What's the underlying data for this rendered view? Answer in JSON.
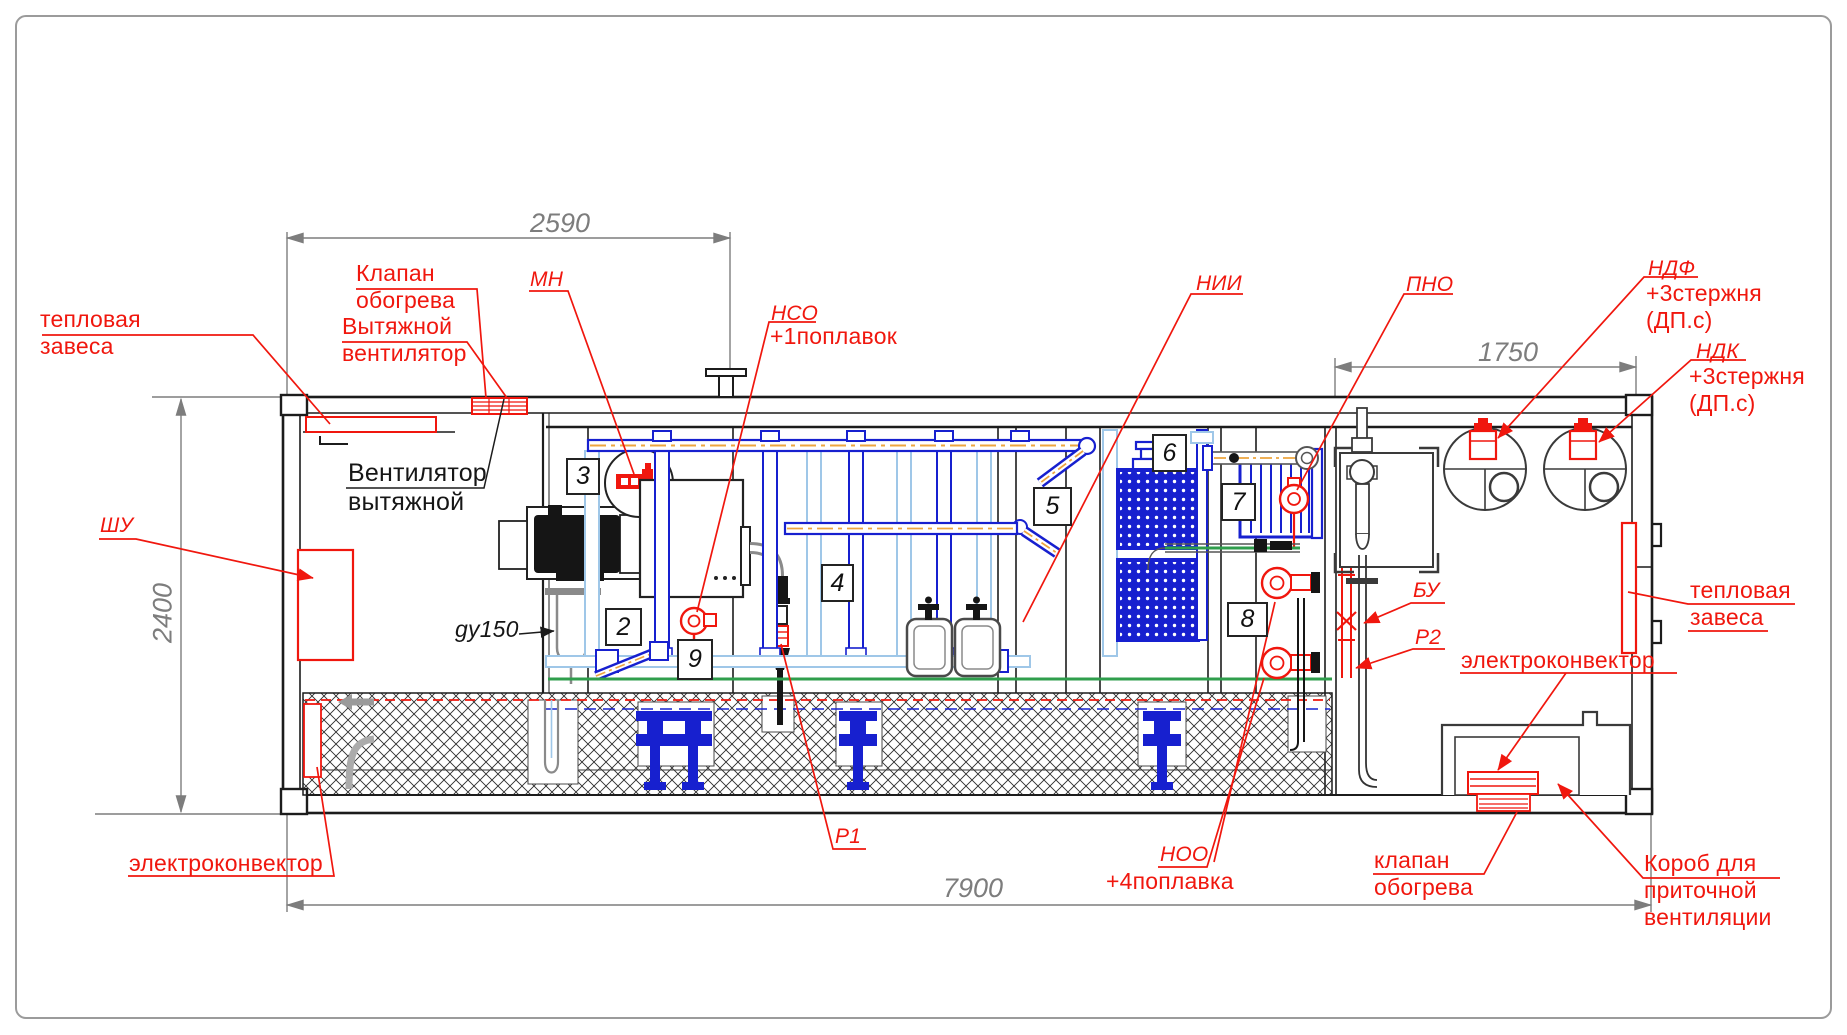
{
  "palette": {
    "red": "#f0170e",
    "blue": "#1720cf",
    "pale_blue": "#9fc7e8",
    "orange": "#eda53f",
    "green": "#2f9e4c",
    "dim_gray": "#7d7d7d",
    "line_black": "#1c1c1c"
  },
  "dimensions_mm": {
    "top_section": "2590",
    "right_section": "1750",
    "height": "2400",
    "length": "7900"
  },
  "position_numbers": {
    "p2": "2",
    "p3": "3",
    "p4": "4",
    "p5": "5",
    "p6": "6",
    "p7": "7",
    "p8": "8",
    "p9": "9"
  },
  "labels": {
    "thermal_curtain_left": "тепловая\nзавеса",
    "heating_valve_top": "Клапан\nобогрева",
    "exhaust_fan_red": "Вытяжной\nвентилятор",
    "exhaust_fan_black": "Вентилятор\nвытяжной",
    "mn": "МН",
    "nso": "НСО",
    "nso_note": "+1поплавок",
    "nii": "НИИ",
    "pno": "ПНО",
    "ndf": "НДФ",
    "ndf_note": "+3стержня\n(ДП.с)",
    "ndk": "НДК",
    "ndk_note": "+3стержня\n(ДП.с)",
    "shu": "ШУ",
    "gy150": "gy150",
    "bu": "БУ",
    "r2": "Р2",
    "r1": "Р1",
    "noo": "НОО",
    "noo_note": "+4поплавка",
    "thermal_curtain_right": "тепловая\nзавеса",
    "electroconvector_right": "электроконвектор",
    "electroconvector_left": "электроконвектор",
    "heating_valve_bottom": "клапан\nобогрева",
    "supply_vent_duct": "Короб для\nприточной\nвентиляции"
  }
}
